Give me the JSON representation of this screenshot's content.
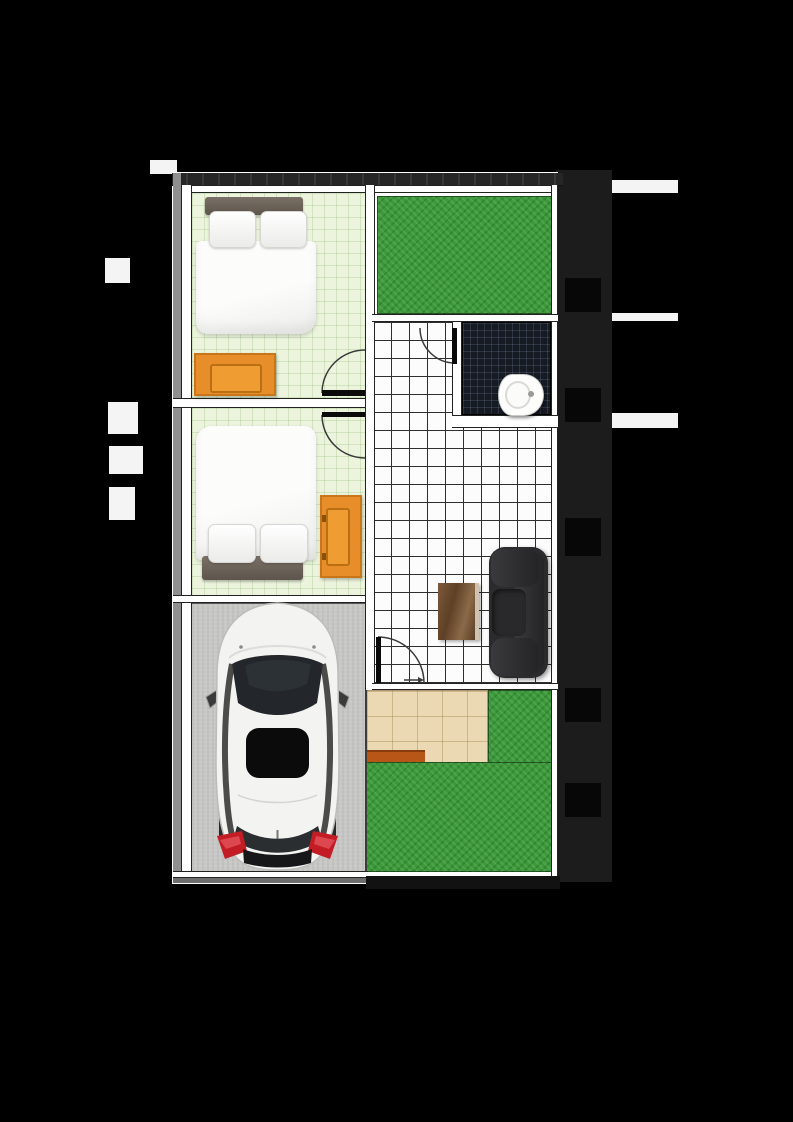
{
  "meta": {
    "type": "architectural floor plan, top view, no visible text labels",
    "visible_text": ""
  },
  "colors": {
    "page_black": "#000000",
    "margin_gray": "#1c1c1c",
    "margin_white": "#f4f4f4",
    "wall_gray": "#8f8f8f",
    "wall_line": "#222222",
    "bedroom_floor": "#ecf4de",
    "tile_white": "#fcfcfc",
    "tile_line": "#2e2e2e",
    "bathroom_tile": "#151a23",
    "grass": "#3c993a",
    "terrace": "#ead9b2",
    "step": "#b85618",
    "carport": "#c7c7c5",
    "wardrobe": "#e78e2b",
    "wardrobe_border": "#c9751a",
    "wardrobe_dark": "#b96f12",
    "sofa": "#2b2b2d",
    "car_body": "#f3f3f1",
    "car_glass": "#23262a",
    "taillight": "#c41c24"
  },
  "rooms": [
    {
      "name": "Bedroom 1",
      "floor": "pale green grid",
      "contents": [
        "double bed",
        "orange wardrobe",
        "swing door"
      ]
    },
    {
      "name": "Bedroom 2",
      "floor": "pale green grid",
      "contents": [
        "double bed",
        "orange wardrobe",
        "swing door"
      ]
    },
    {
      "name": "Bathroom",
      "floor": "dark mosaic tile",
      "contents": [
        "toilet",
        "swing door"
      ]
    },
    {
      "name": "Hall / Living room",
      "floor": "white grid tile",
      "contents": [
        "sofa",
        "coffee table",
        "terrace door"
      ]
    },
    {
      "name": "Front yard",
      "floor": "grass"
    },
    {
      "name": "Terrace",
      "floor": "tan tile with entry step"
    },
    {
      "name": "Garden",
      "floor": "grass"
    },
    {
      "name": "Carport",
      "floor": "concrete",
      "contents": [
        "white car top view"
      ]
    }
  ],
  "furniture": [
    {
      "name": "bed-1",
      "room": "Bedroom 1"
    },
    {
      "name": "wardrobe-1",
      "room": "Bedroom 1"
    },
    {
      "name": "bed-2",
      "room": "Bedroom 2"
    },
    {
      "name": "wardrobe-2",
      "room": "Bedroom 2"
    },
    {
      "name": "toilet",
      "room": "Bathroom"
    },
    {
      "name": "sofa",
      "room": "Living room"
    },
    {
      "name": "coffee-table",
      "room": "Living room"
    },
    {
      "name": "car",
      "room": "Carport"
    }
  ],
  "doors": [
    {
      "name": "bedroom-1-door",
      "swing": "into bedroom 1"
    },
    {
      "name": "bedroom-2-door",
      "swing": "into bedroom 2"
    },
    {
      "name": "bathroom-door",
      "swing": "into hall"
    },
    {
      "name": "terrace-door",
      "swing": "onto terrace"
    }
  ]
}
